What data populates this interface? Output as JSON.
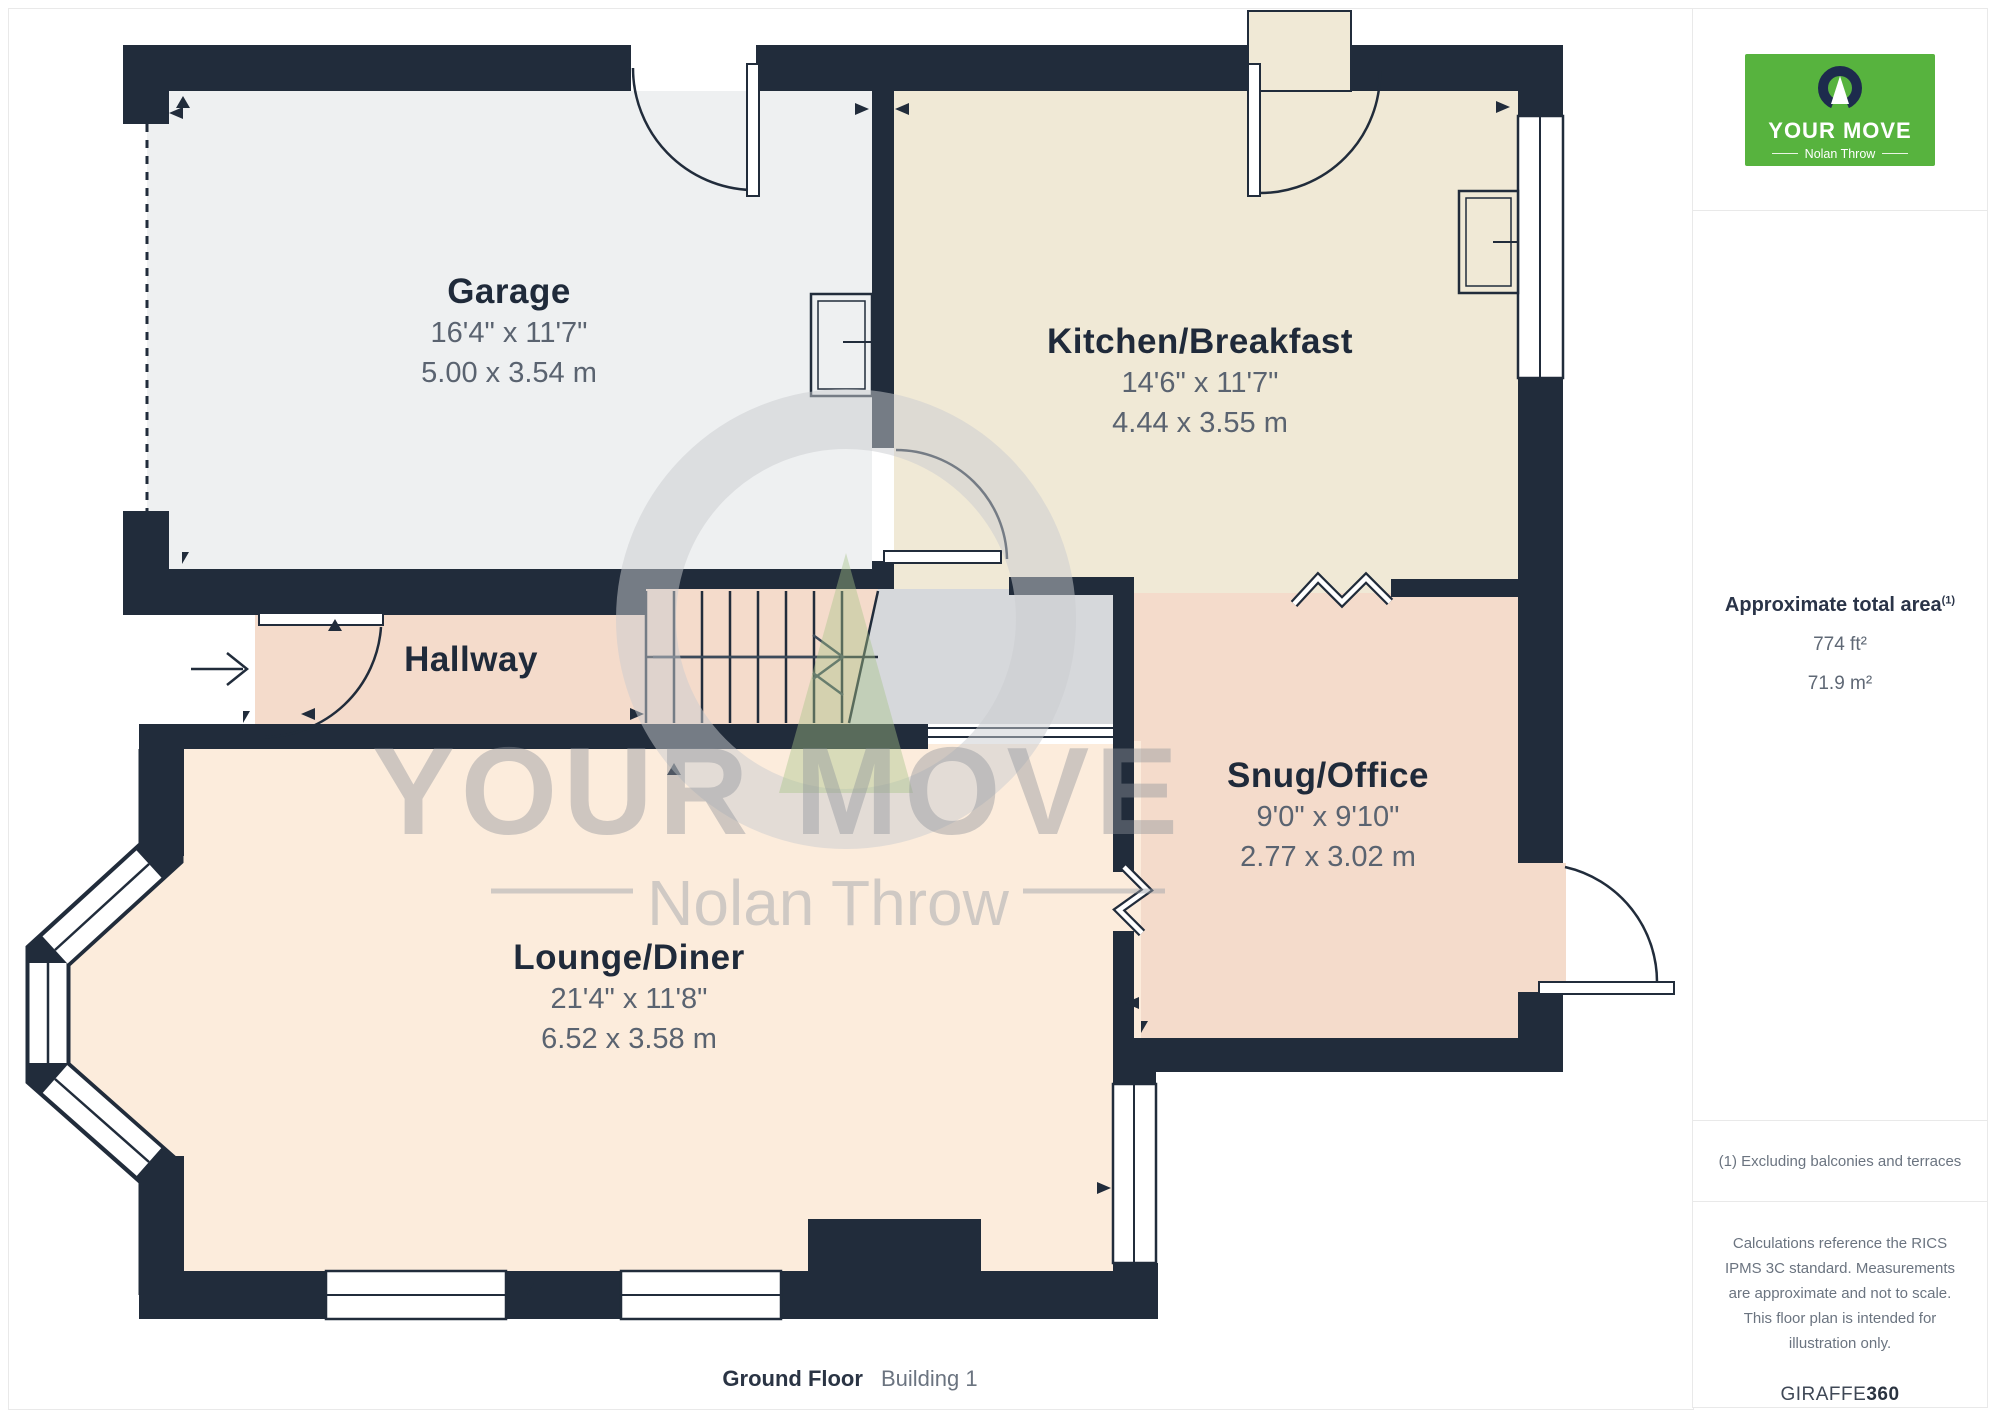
{
  "branding": {
    "logo_title": "YOUR MOVE",
    "logo_subtitle": "Nolan Throw",
    "logo_bg_color": "#57b33e",
    "logo_mark_color": "#1d2b4d"
  },
  "watermark": {
    "line1": "YOUR MOVE",
    "line2": "Nolan Throw"
  },
  "rooms": [
    {
      "id": "garage",
      "name": "Garage",
      "dims_imperial": "16'4\" x 11'7\"",
      "dims_metric": "5.00 x 3.54 m"
    },
    {
      "id": "kitchen",
      "name": "Kitchen/Breakfast",
      "dims_imperial": "14'6\" x 11'7\"",
      "dims_metric": "4.44 x 3.55 m"
    },
    {
      "id": "hallway",
      "name": "Hallway"
    },
    {
      "id": "snug",
      "name": "Snug/Office",
      "dims_imperial": "9'0\" x 9'10\"",
      "dims_metric": "2.77 x 3.02 m"
    },
    {
      "id": "lounge",
      "name": "Lounge/Diner",
      "dims_imperial": "21'4\" x 11'8\"",
      "dims_metric": "6.52 x 3.58 m"
    }
  ],
  "sidebar": {
    "area_title": "Approximate total area",
    "area_superscript": "(1)",
    "area_imperial": "774 ft²",
    "area_metric": "71.9 m²",
    "footnote": "(1) Excluding balconies and terraces",
    "disclaimer": "Calculations reference the RICS IPMS 3C standard. Measurements are approximate and not to scale. This floor plan is intended for illustration only.",
    "brand_word": "GIRAFFE",
    "brand_number": "360"
  },
  "footer": {
    "floor_label": "Ground Floor",
    "building_label": "Building 1"
  },
  "palette": {
    "wall": "#212c3b",
    "garage_floor": "#eef0f1",
    "kitchen_floor": "#f0e9d6",
    "hallway_snug_floor": "#f4dbcb",
    "lounge_floor": "#fcecdc",
    "unmeasured_gray": "#d6d8db",
    "label_navy": "#1f2a3a",
    "dim_gray": "#5a6370",
    "watermark_gray": "#c9cbd0",
    "logo_green": "#57b33e"
  }
}
